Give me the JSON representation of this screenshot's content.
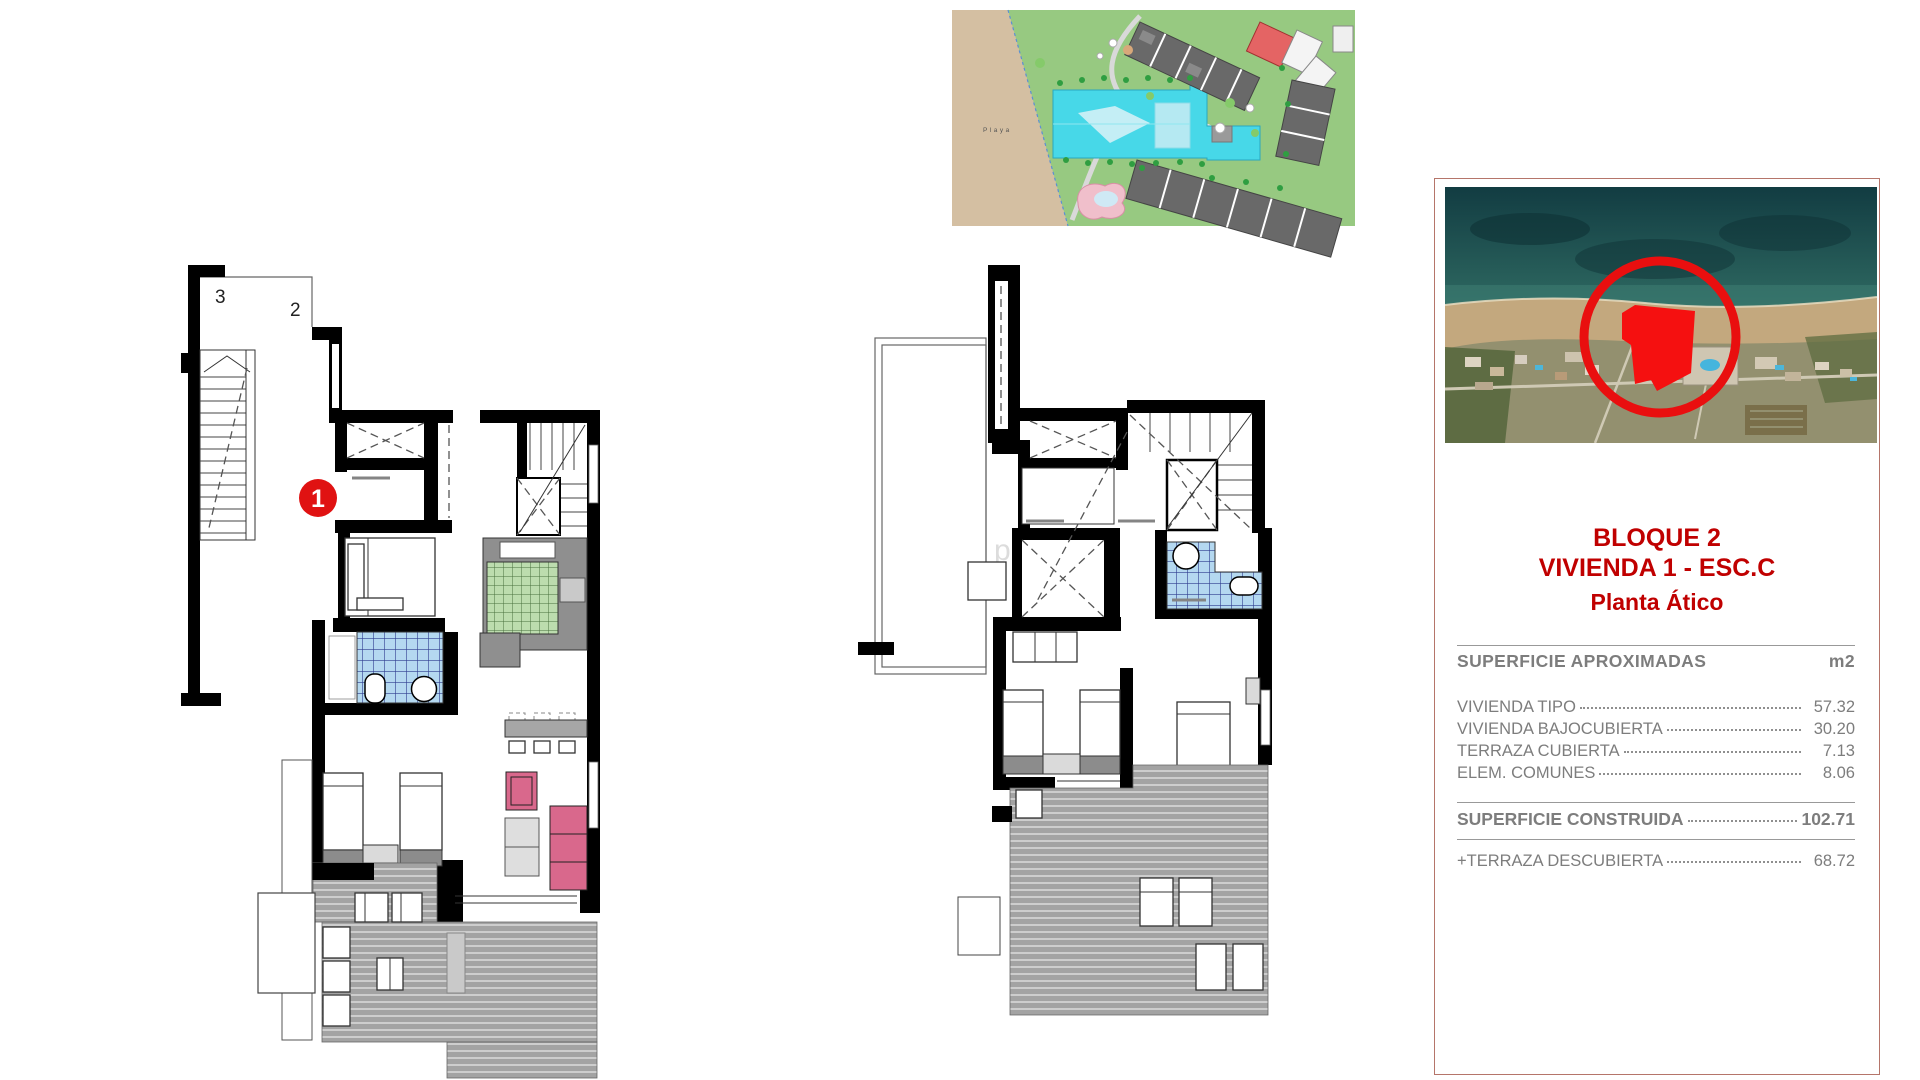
{
  "site_plan": {
    "beach_label": "Playa"
  },
  "floor_plan_atico": {
    "room_label_top_left": "3",
    "room_label_top_right": "2",
    "unit_badge": "1"
  },
  "watermark_text": "perty no",
  "info_panel": {
    "title_lines": [
      "BLOQUE 2",
      "VIVIENDA 1 - ESC.C",
      "Planta Ático"
    ],
    "areas_table": {
      "header": "SUPERFICIE APROXIMADAS",
      "unit_header": "m2",
      "rows": [
        {
          "label": "VIVIENDA TIPO",
          "value": "57.32"
        },
        {
          "label": "VIVIENDA BAJOCUBIERTA",
          "value": "30.20"
        },
        {
          "label": "TERRAZA CUBIERTA",
          "value": "7.13"
        },
        {
          "label": "ELEM. COMUNES",
          "value": "8.06"
        }
      ],
      "total": {
        "label": "SUPERFICIE CONSTRUIDA",
        "value": "102.71"
      },
      "extra": {
        "label": "+TERRAZA DESCUBIERTA",
        "value": "68.72"
      }
    }
  },
  "colors": {
    "accent_red": "#c00000",
    "badge_red": "#e01212",
    "marker_red": "#e90f0f",
    "text_gray": "#7d7d7d",
    "panel_border": "#b5756a",
    "tile_blue": "#b4d8f0",
    "tile_green": "#bcdcae",
    "sofa_pink": "#d9688c",
    "deck_gray": "#a3a3a3",
    "pool_cyan": "#47d8e8",
    "beach_tan": "#d4bfa2",
    "site_green": "#97c981",
    "building_gray": "#696969"
  }
}
